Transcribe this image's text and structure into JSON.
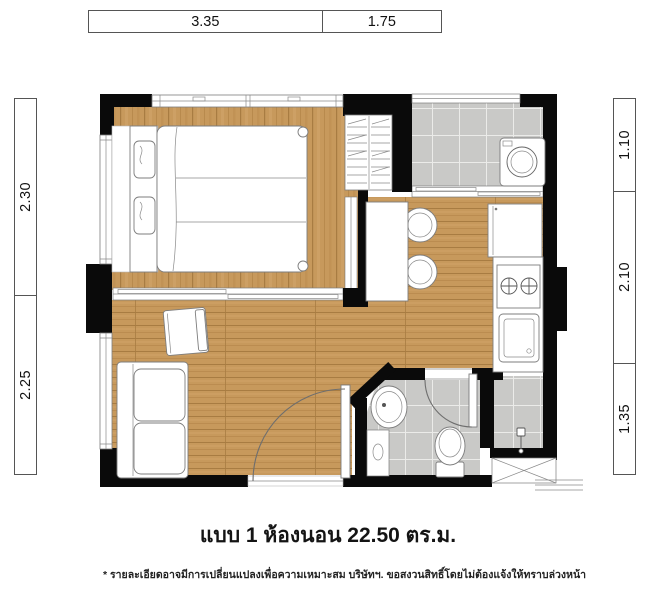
{
  "dimensions": {
    "top": [
      "3.35",
      "1.75"
    ],
    "left": [
      "2.30",
      "2.25"
    ],
    "right": [
      "1.10",
      "2.10",
      "1.35"
    ]
  },
  "caption": {
    "title": "แบบ 1 ห้องนอน 22.50 ตร.ม.",
    "footnote": "* รายละเอียดอาจมีการเปลี่ยนแปลงเพื่อความเหมาะสม บริษัทฯ. ขอสงวนสิทธิ์โดยไม่ต้องแจ้งให้ทราบล่วงหน้า"
  },
  "colors": {
    "wall": "#0a0a0a",
    "wood_base": "#c7995c",
    "wood_grain": "#a87c42",
    "tile": "#c9c9c7",
    "tile_grout": "#ebebe9",
    "furniture_stroke": "#7d7d7d"
  }
}
